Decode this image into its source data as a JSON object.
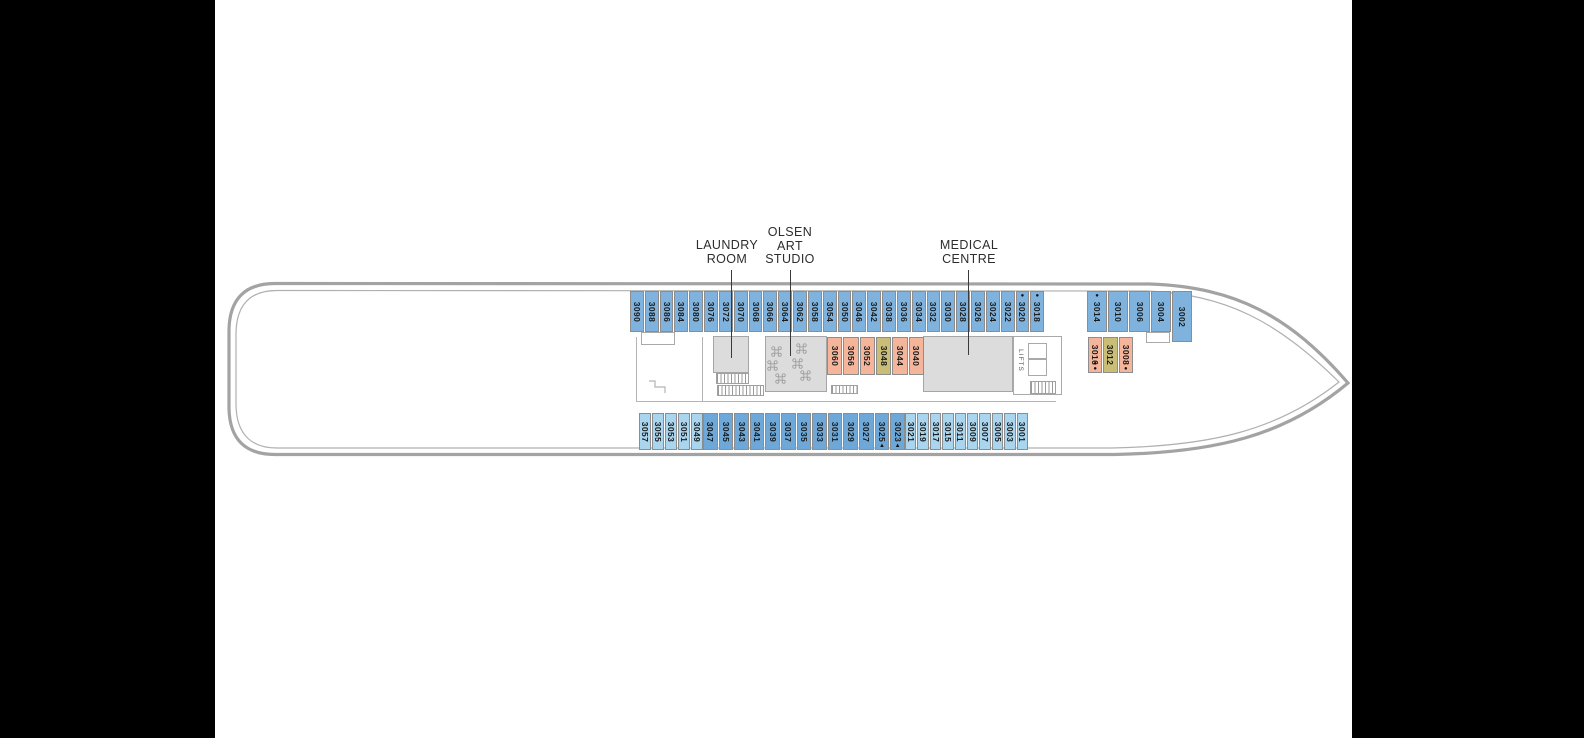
{
  "deck_plan": {
    "labels": {
      "laundry": [
        "LAUNDRY",
        "ROOM"
      ],
      "olsen": [
        "OLSEN",
        "ART",
        "STUDIO"
      ],
      "medical": [
        "MEDICAL",
        "CENTRE"
      ],
      "lifts": "LIFTS"
    },
    "colors": {
      "cabin_blue": "#7fb3de",
      "cabin_blue_dark": "#6ea8d8",
      "cabin_blue_light": "#a9d5ef",
      "cabin_salmon": "#f4b59b",
      "cabin_olive": "#c9bd78",
      "structure_fill": "#dcdcdc",
      "hull_line": "#a3a3a3"
    },
    "cabin_groups": {
      "top-aft": {
        "color": "cabin_blue",
        "cabins": [
          {
            "n": "3090"
          },
          {
            "n": "3088"
          },
          {
            "n": "3086"
          },
          {
            "n": "3084"
          },
          {
            "n": "3080"
          },
          {
            "n": "3076"
          },
          {
            "n": "3072"
          },
          {
            "n": "3070"
          },
          {
            "n": "3068"
          },
          {
            "n": "3066"
          },
          {
            "n": "3064"
          },
          {
            "n": "3062"
          },
          {
            "n": "3058"
          },
          {
            "n": "3054"
          },
          {
            "n": "3050"
          },
          {
            "n": "3046"
          },
          {
            "n": "3042"
          },
          {
            "n": "3038"
          },
          {
            "n": "3036"
          },
          {
            "n": "3034"
          },
          {
            "n": "3032"
          },
          {
            "n": "3030"
          },
          {
            "n": "3028"
          },
          {
            "n": "3026"
          },
          {
            "n": "3024"
          },
          {
            "n": "3022"
          },
          {
            "n": "3020",
            "pre": "●"
          },
          {
            "n": "3018",
            "pre": "●"
          }
        ]
      },
      "top-fwd": {
        "color": "cabin_blue",
        "cabins": [
          {
            "n": "3014",
            "pre": "●"
          },
          {
            "n": "3010"
          },
          {
            "n": "3006"
          },
          {
            "n": "3004"
          },
          {
            "n": "3002",
            "tall": true
          }
        ]
      },
      "mid-aft": {
        "color": "cabin_salmon",
        "cabins": [
          {
            "n": "3060"
          },
          {
            "n": "3056"
          },
          {
            "n": "3052"
          },
          {
            "n": "3048",
            "c": "cabin_olive"
          },
          {
            "n": "3044"
          },
          {
            "n": "3040"
          }
        ]
      },
      "mid-fwd": {
        "color": "cabin_salmon",
        "cabins": [
          {
            "n": "3016",
            "post": "●●"
          },
          {
            "n": "3012",
            "c": "cabin_olive"
          },
          {
            "n": "3008",
            "post": "●"
          }
        ]
      },
      "bot-aft": {
        "color": "cabin_blue_light",
        "cabins": [
          {
            "n": "3057"
          },
          {
            "n": "3055"
          },
          {
            "n": "3053"
          },
          {
            "n": "3051"
          },
          {
            "n": "3049"
          }
        ]
      },
      "bot-mid": {
        "color": "cabin_blue_dark",
        "cabins": [
          {
            "n": "3047"
          },
          {
            "n": "3045"
          },
          {
            "n": "3043"
          },
          {
            "n": "3041"
          },
          {
            "n": "3039"
          },
          {
            "n": "3037"
          },
          {
            "n": "3035"
          },
          {
            "n": "3033"
          },
          {
            "n": "3031"
          },
          {
            "n": "3029"
          },
          {
            "n": "3027"
          },
          {
            "n": "3025",
            "post": "▲"
          },
          {
            "n": "3023",
            "post": "▲"
          }
        ]
      },
      "bot-fwd": {
        "color": "cabin_blue_light",
        "cabins": [
          {
            "n": "3021"
          },
          {
            "n": "3019"
          },
          {
            "n": "3017"
          },
          {
            "n": "3015"
          },
          {
            "n": "3011"
          },
          {
            "n": "3009"
          },
          {
            "n": "3007"
          },
          {
            "n": "3005"
          },
          {
            "n": "3003"
          },
          {
            "n": "3001"
          }
        ]
      }
    }
  }
}
